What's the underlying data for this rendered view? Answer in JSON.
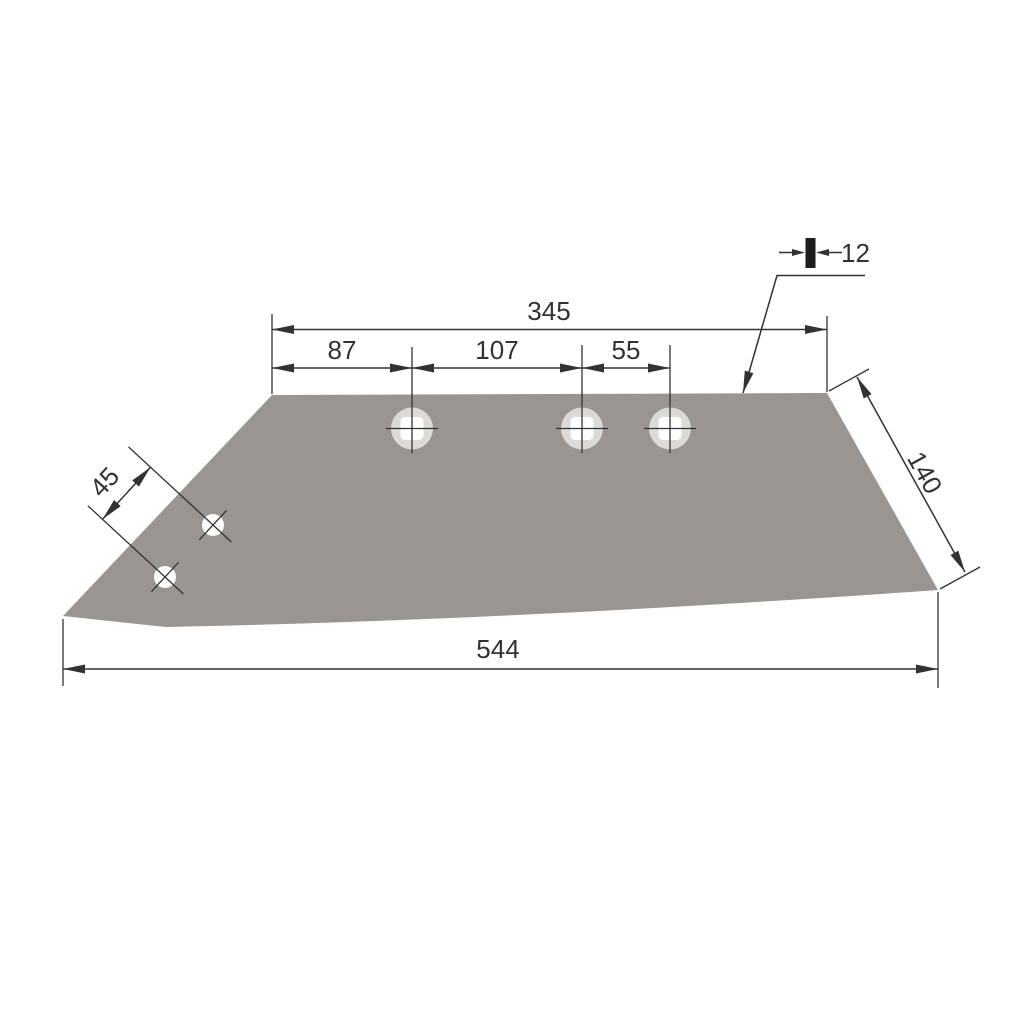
{
  "drawing": {
    "title": "plow-share-blade-technical-drawing",
    "labels": {
      "top_overall": "345",
      "seg_left": "87",
      "seg_mid": "107",
      "seg_right": "55",
      "thickness": "12",
      "diag_hole_spacing": "45",
      "right_edge": "140",
      "bottom_overall": "544"
    },
    "colors": {
      "background": "#FFFFFF",
      "blade_fill": "#9A9590",
      "counterbore": "#DBDAD7",
      "hole": "#FFFFFF",
      "line": "#333230",
      "text": "#333230",
      "thickness_bar": "#1E1D1B"
    }
  }
}
